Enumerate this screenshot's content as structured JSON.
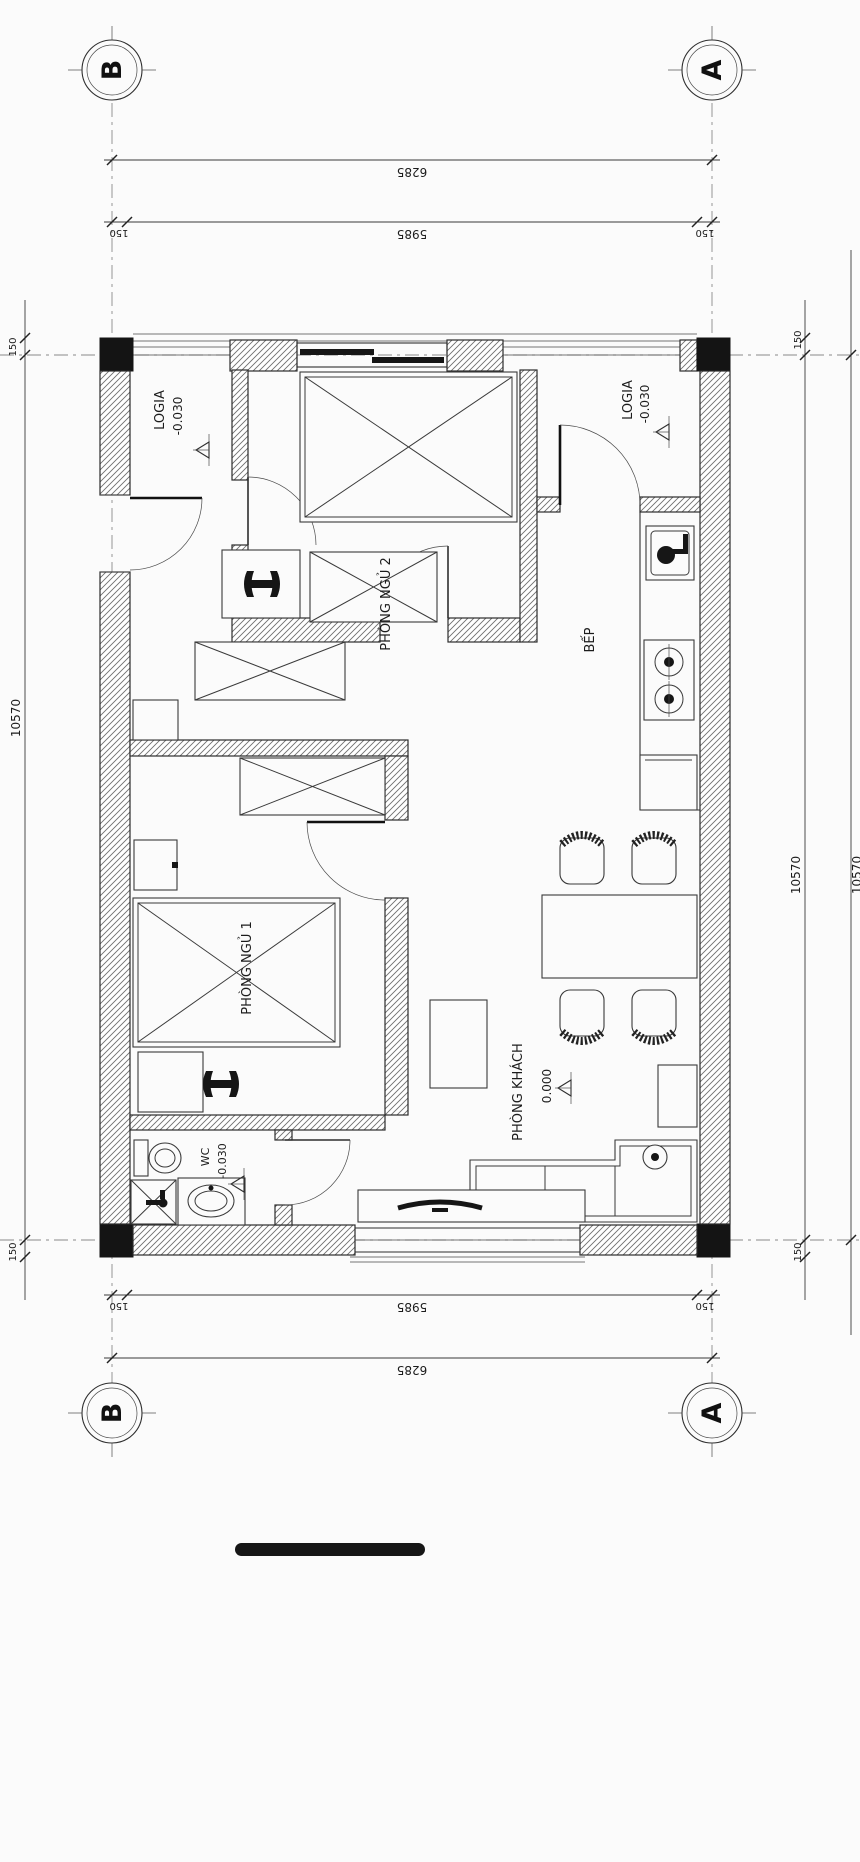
{
  "drawing": {
    "title_hint": "apartment floor plan",
    "grid_axes": {
      "left": "B",
      "right": "A"
    },
    "dimensions": {
      "top": {
        "total": "6285",
        "clear": "5985",
        "offset_left": "150",
        "offset_right": "150"
      },
      "bottom": {
        "total": "6285",
        "clear": "5985",
        "offset_left": "150",
        "offset_right": "150"
      },
      "left": {
        "total": "10570",
        "offset_top": "150",
        "offset_bottom": "150"
      },
      "right": {
        "total": "10570",
        "outer_total": "10570",
        "offset_top": "150",
        "offset_bottom": "150"
      }
    },
    "rooms": {
      "logia_left": {
        "name": "LOGIA",
        "level": "-0.030"
      },
      "logia_right": {
        "name": "LOGIA",
        "level": "-0.030"
      },
      "bedroom2": {
        "name": "PHÒNG NGỦ 2"
      },
      "bedroom1": {
        "name": "PHÒNG NGỦ 1"
      },
      "kitchen": {
        "name": "BẾP"
      },
      "living": {
        "name": "PHÒNG KHÁCH",
        "level": "0.000"
      },
      "wc": {
        "name": "WC",
        "level": "-0.030"
      }
    },
    "colors": {
      "line": "#2e2e2e",
      "column_fill": "#141414",
      "background": "#fbfbfb"
    }
  }
}
